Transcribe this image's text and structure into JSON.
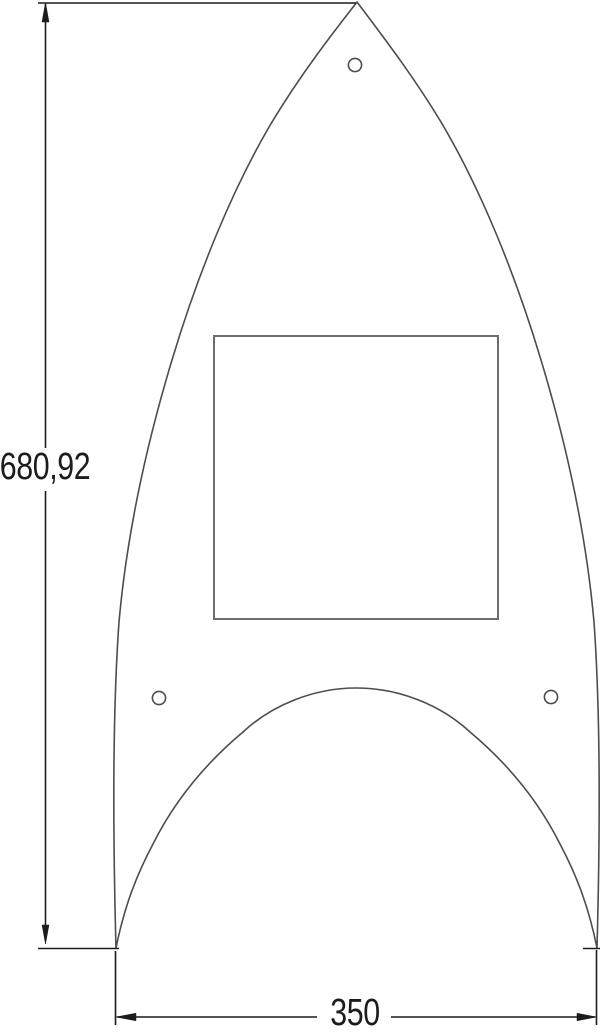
{
  "drawing": {
    "type": "technical-drawing",
    "background_color": "#ffffff",
    "outline_color": "#4d4d4d",
    "cutout_color": "#6e6e6e",
    "dimension_color": "#1c1c1c",
    "dimensions": {
      "height": {
        "label": "680,92",
        "value": 680.92,
        "orientation": "vertical"
      },
      "width": {
        "label": "350",
        "value": 350,
        "orientation": "horizontal"
      }
    },
    "features": {
      "outer_profile": "pointed-arch plate",
      "square_cutout_count": 1,
      "round_hole_count": 3,
      "bottom_arch_cutout_count": 1
    }
  }
}
